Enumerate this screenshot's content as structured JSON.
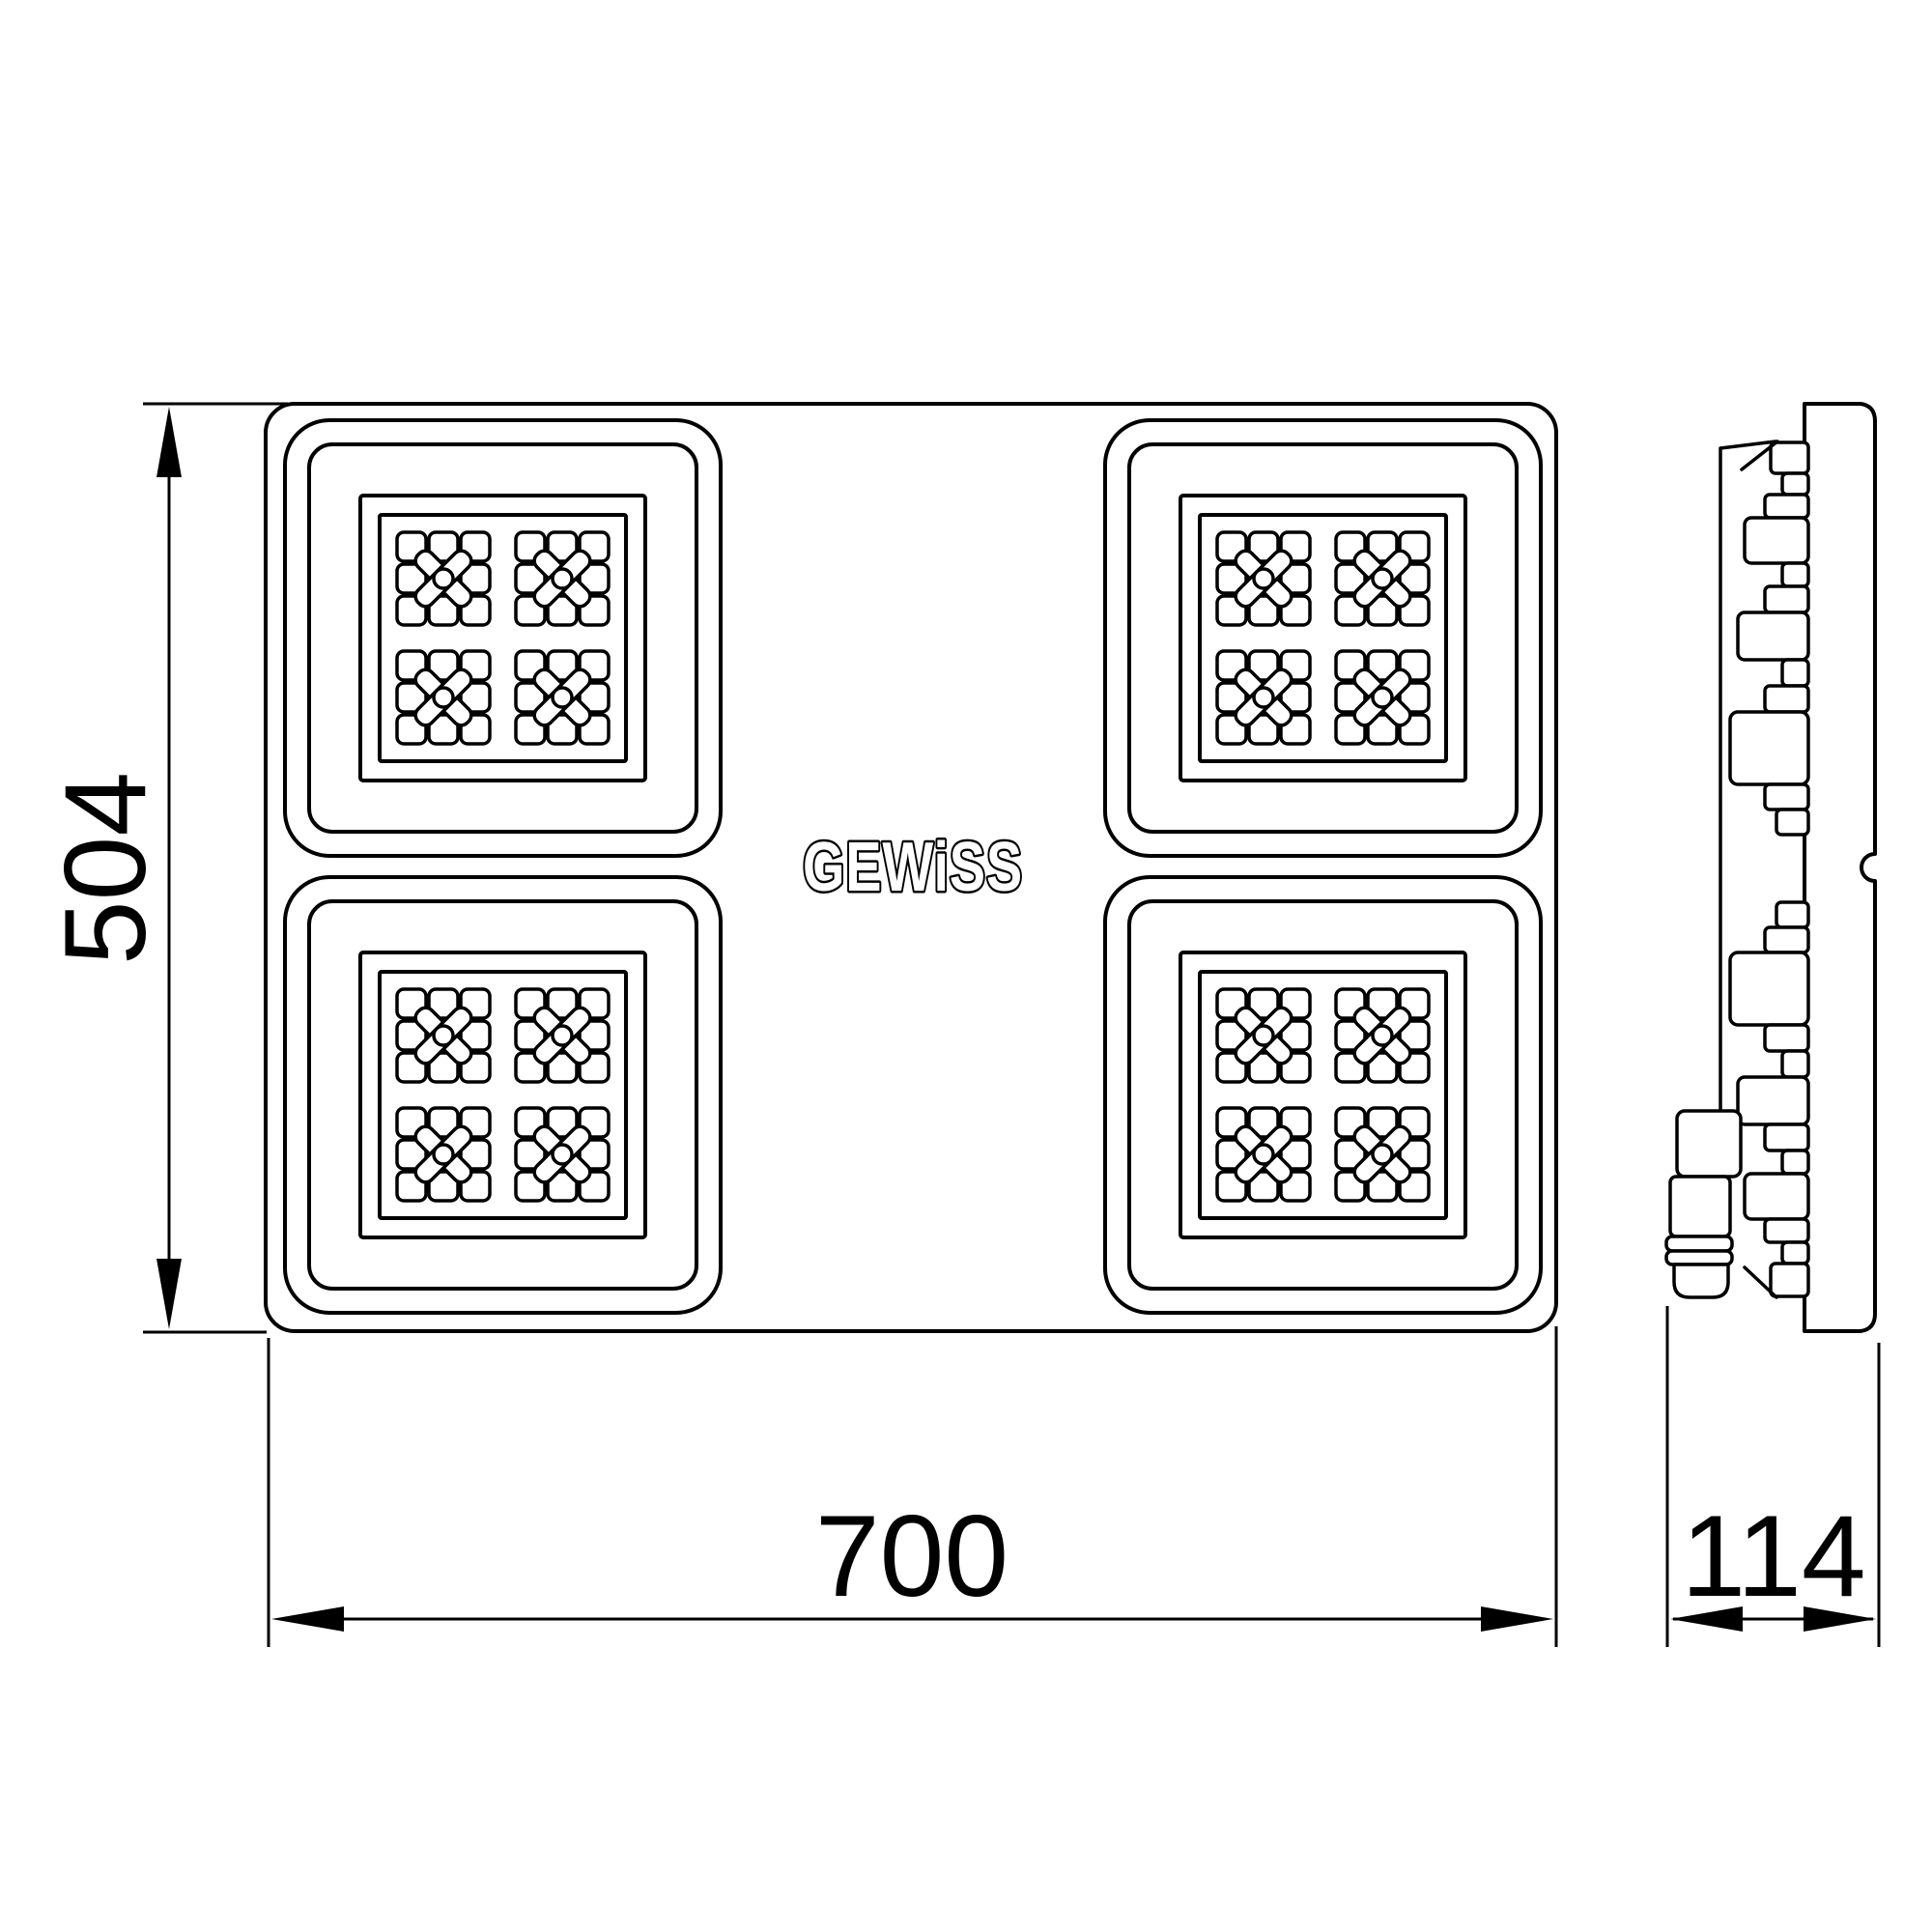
{
  "drawing": {
    "brand": "GEWiSS",
    "dimensions": {
      "height": {
        "value": "504",
        "orientation": "vertical",
        "applies_to": "front view height"
      },
      "width": {
        "value": "700",
        "orientation": "horizontal",
        "applies_to": "front view width"
      },
      "depth": {
        "value": "114",
        "orientation": "horizontal",
        "applies_to": "side view depth"
      }
    },
    "front_view": {
      "panel_rows": 2,
      "panel_cols": 2,
      "modules_per_panel": 4,
      "cells_per_module": "3x3"
    },
    "side_view": {
      "features": [
        "front plate",
        "heatsink fins",
        "cable gland"
      ]
    },
    "colors": {
      "line": "#000000",
      "background": "#ffffff"
    }
  }
}
